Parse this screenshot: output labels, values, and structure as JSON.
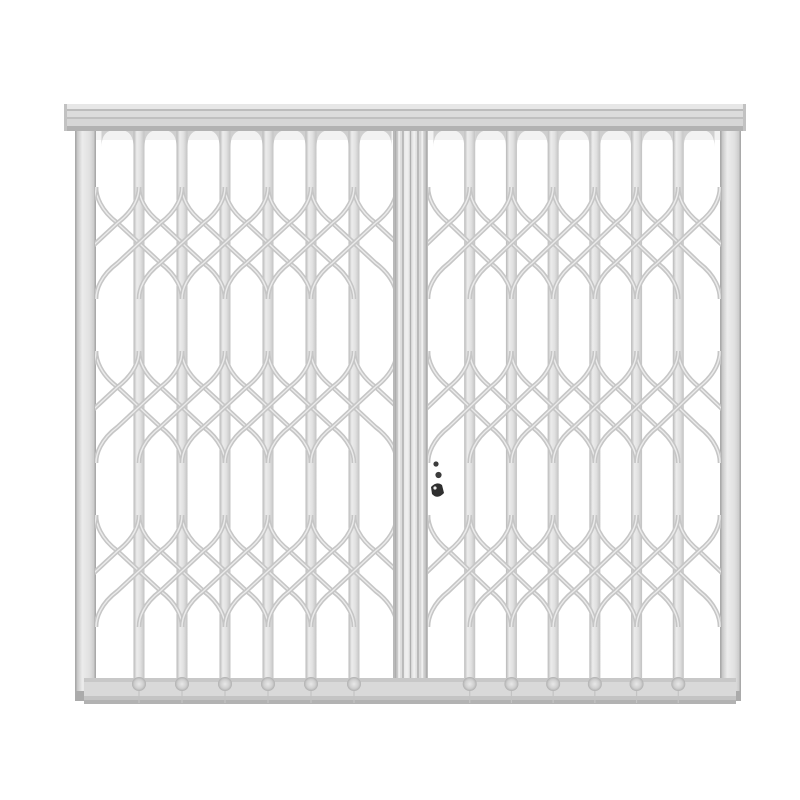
{
  "scene": {
    "background": "#ffffff",
    "subject": "white steel folding trellis security gate, two leaves, closed, front view"
  },
  "gate": {
    "width": 800,
    "height": 800,
    "colors": {
      "bar_edge": "#b7b7b7",
      "bar_mid": "#ececec",
      "bar_mid2": "#e0e0e0",
      "bar_edge2": "#c2c2c2",
      "lattice": "#c6c6c6",
      "lattice_highlight": "#ebebeb",
      "rail_light": "#e7e7e7",
      "rail_line": "#bcbcbc",
      "rail_face": "#dcdcdc",
      "rail_line2": "#c0c0c0",
      "rail_mid": "#d6d6d6",
      "rail_dark": "#b2b2b2",
      "rail_cap": "#c2c2c2",
      "post_edge": "#a9a9a9",
      "post_tip": "#ababab",
      "fillet": "#cfcfcf",
      "stile_ridge": "#aeaeae",
      "stile_highlight": "#efefef",
      "stile_foot": "#9b9b9b",
      "foot_light": "#e8e8e8",
      "foot_mid": "#cfcfcf",
      "foot_dark": "#b0b0b0",
      "seam": "#c3c3c3",
      "lock_dark": "#2f2f2f",
      "lock_mid": "#3c3c3c",
      "shadow": "#000000"
    },
    "header_rail": {
      "x": 64,
      "y": 104,
      "w": 682,
      "h": 27
    },
    "posts": {
      "left_x": 75,
      "right_x": 720,
      "w": 21,
      "top": 131,
      "bottom": 701
    },
    "leaves": [
      {
        "x0": 96,
        "x1": 397
      },
      {
        "x0": 428,
        "x1": 720
      }
    ],
    "interior_bars": 6,
    "bar_w": 11,
    "bars_top": 131,
    "bars_bottom": 679,
    "lattice_bands": [
      203,
      367,
      531
    ],
    "row_h": 20,
    "rows": 4,
    "flare": 16,
    "stroke_w": 4.6,
    "bottom_rail": {
      "x": 84,
      "y": 678,
      "w": 652,
      "h": 26
    },
    "center_stile": {
      "x": 393,
      "w": 35,
      "top": 131,
      "bottom": 702,
      "ridges": [
        395.5,
        403,
        410.5,
        418,
        426.5
      ]
    },
    "lock": {
      "marks": [
        {
          "x": 436,
          "y": 464,
          "r": 2.6
        },
        {
          "x": 438.5,
          "y": 475,
          "r": 3.1
        }
      ],
      "hook": {
        "x": 431,
        "y": 483,
        "w": 13,
        "h": 15
      }
    }
  }
}
